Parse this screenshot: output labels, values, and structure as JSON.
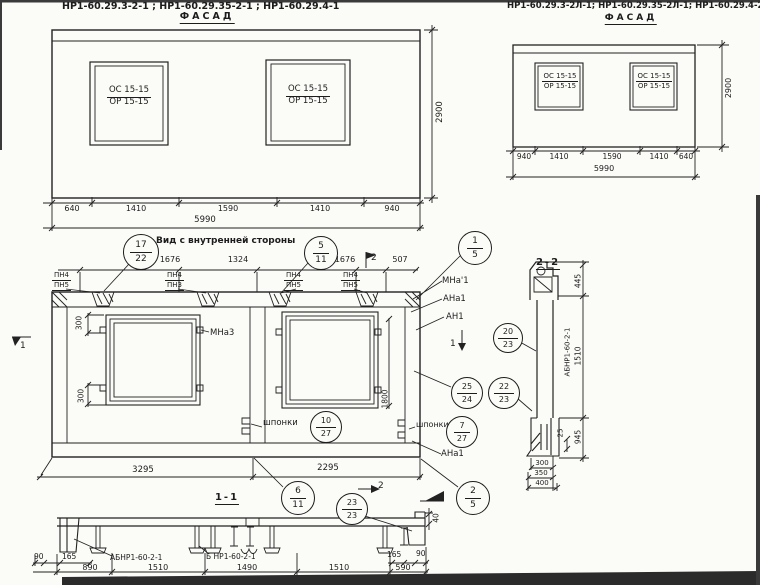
{
  "facade_left": {
    "title": "НР1-60.29.3-2-1 ;    НР1-60.29.35-2-1 ;    НР1-60.29.4-1",
    "subtitle": "ФАСАД",
    "windows": [
      {
        "mark1": "ОС 15-15",
        "mark2": "ОР 15-15"
      },
      {
        "mark1": "ОС 15-15",
        "mark2": "ОР 15-15"
      }
    ],
    "height_dim": "2900",
    "width_dims": [
      "640",
      "1410",
      "1590",
      "1410",
      "940"
    ],
    "total_width": "5990"
  },
  "facade_right": {
    "title": "НР1-60.29.3-2Л-1; НР1-60.29.35-2Л-1; НР1-60.29.4-2Л-1",
    "subtitle": "ФАСАД",
    "windows": [
      {
        "mark1": "ОС 15-15",
        "mark2": "ОР 15-15"
      },
      {
        "mark1": "ОС 15-15",
        "mark2": "ОР 15-15"
      }
    ],
    "height_dim": "2900",
    "width_dims": [
      "940",
      "1410",
      "1590",
      "1410",
      "640"
    ],
    "total_width": "5990"
  },
  "inner_view": {
    "title": "Вид с внутренней стороны",
    "top_dims": [
      "1676",
      "1324",
      "1676",
      "507"
    ],
    "pn_marks": [
      {
        "top": "ПН4",
        "bottom": "ПН5"
      },
      {
        "top": "ПН4",
        "bottom": "ПН3"
      },
      {
        "top": "ПН4",
        "bottom": "ПН5"
      },
      {
        "top": "ПН4",
        "bottom": "ПН5"
      }
    ],
    "dim_300_top": "300",
    "dim_300_bottom": "300",
    "dim_1800": "1800",
    "label_mna3": "МНа3",
    "label_mna1": "МНа'1",
    "label_ana1_right": "АНа1",
    "label_an1": "АН1",
    "label_shponki_left": "шпонки",
    "label_shponki_right": "шпонки",
    "label_ana1_bottom": "АНа1",
    "bottom_dims": [
      "3295",
      "2295"
    ],
    "section_marks": {
      "s1": "1",
      "s2": "2"
    }
  },
  "callouts": {
    "c17_22": {
      "top": "17",
      "bottom": "22"
    },
    "c5_11": {
      "top": "5",
      "bottom": "11"
    },
    "c1_5": {
      "top": "1",
      "bottom": "5"
    },
    "c20_23": {
      "top": "20",
      "bottom": "23"
    },
    "c25_24": {
      "top": "25",
      "bottom": "24"
    },
    "c22_23": {
      "top": "22",
      "bottom": "23"
    },
    "c10_27": {
      "top": "10",
      "bottom": "27"
    },
    "c7_27": {
      "top": "7",
      "bottom": "27"
    },
    "c6_11": {
      "top": "6",
      "bottom": "11"
    },
    "c23_23": {
      "top": "23",
      "bottom": "23"
    },
    "c2_5": {
      "top": "2",
      "bottom": "5"
    }
  },
  "section_1_1": {
    "title": "1-1",
    "label_left": "АБНР1-60-2-1",
    "label_right": "Б НР1-60-2-1",
    "dims_bottom": [
      "890",
      "1510",
      "1490",
      "1510",
      "590"
    ],
    "dim_90_left": "90",
    "dim_165_left": "165",
    "dim_165_right": "165",
    "dim_90_right": "90",
    "dim_40": "40"
  },
  "section_2_2": {
    "title": "2-2",
    "label_rotated": "АБНР1-60-2-1",
    "dim_445": "445",
    "dim_1510": "1510",
    "dim_945": "945",
    "dim_25": "25",
    "dims_bottom": [
      "300",
      "350",
      "400"
    ]
  }
}
